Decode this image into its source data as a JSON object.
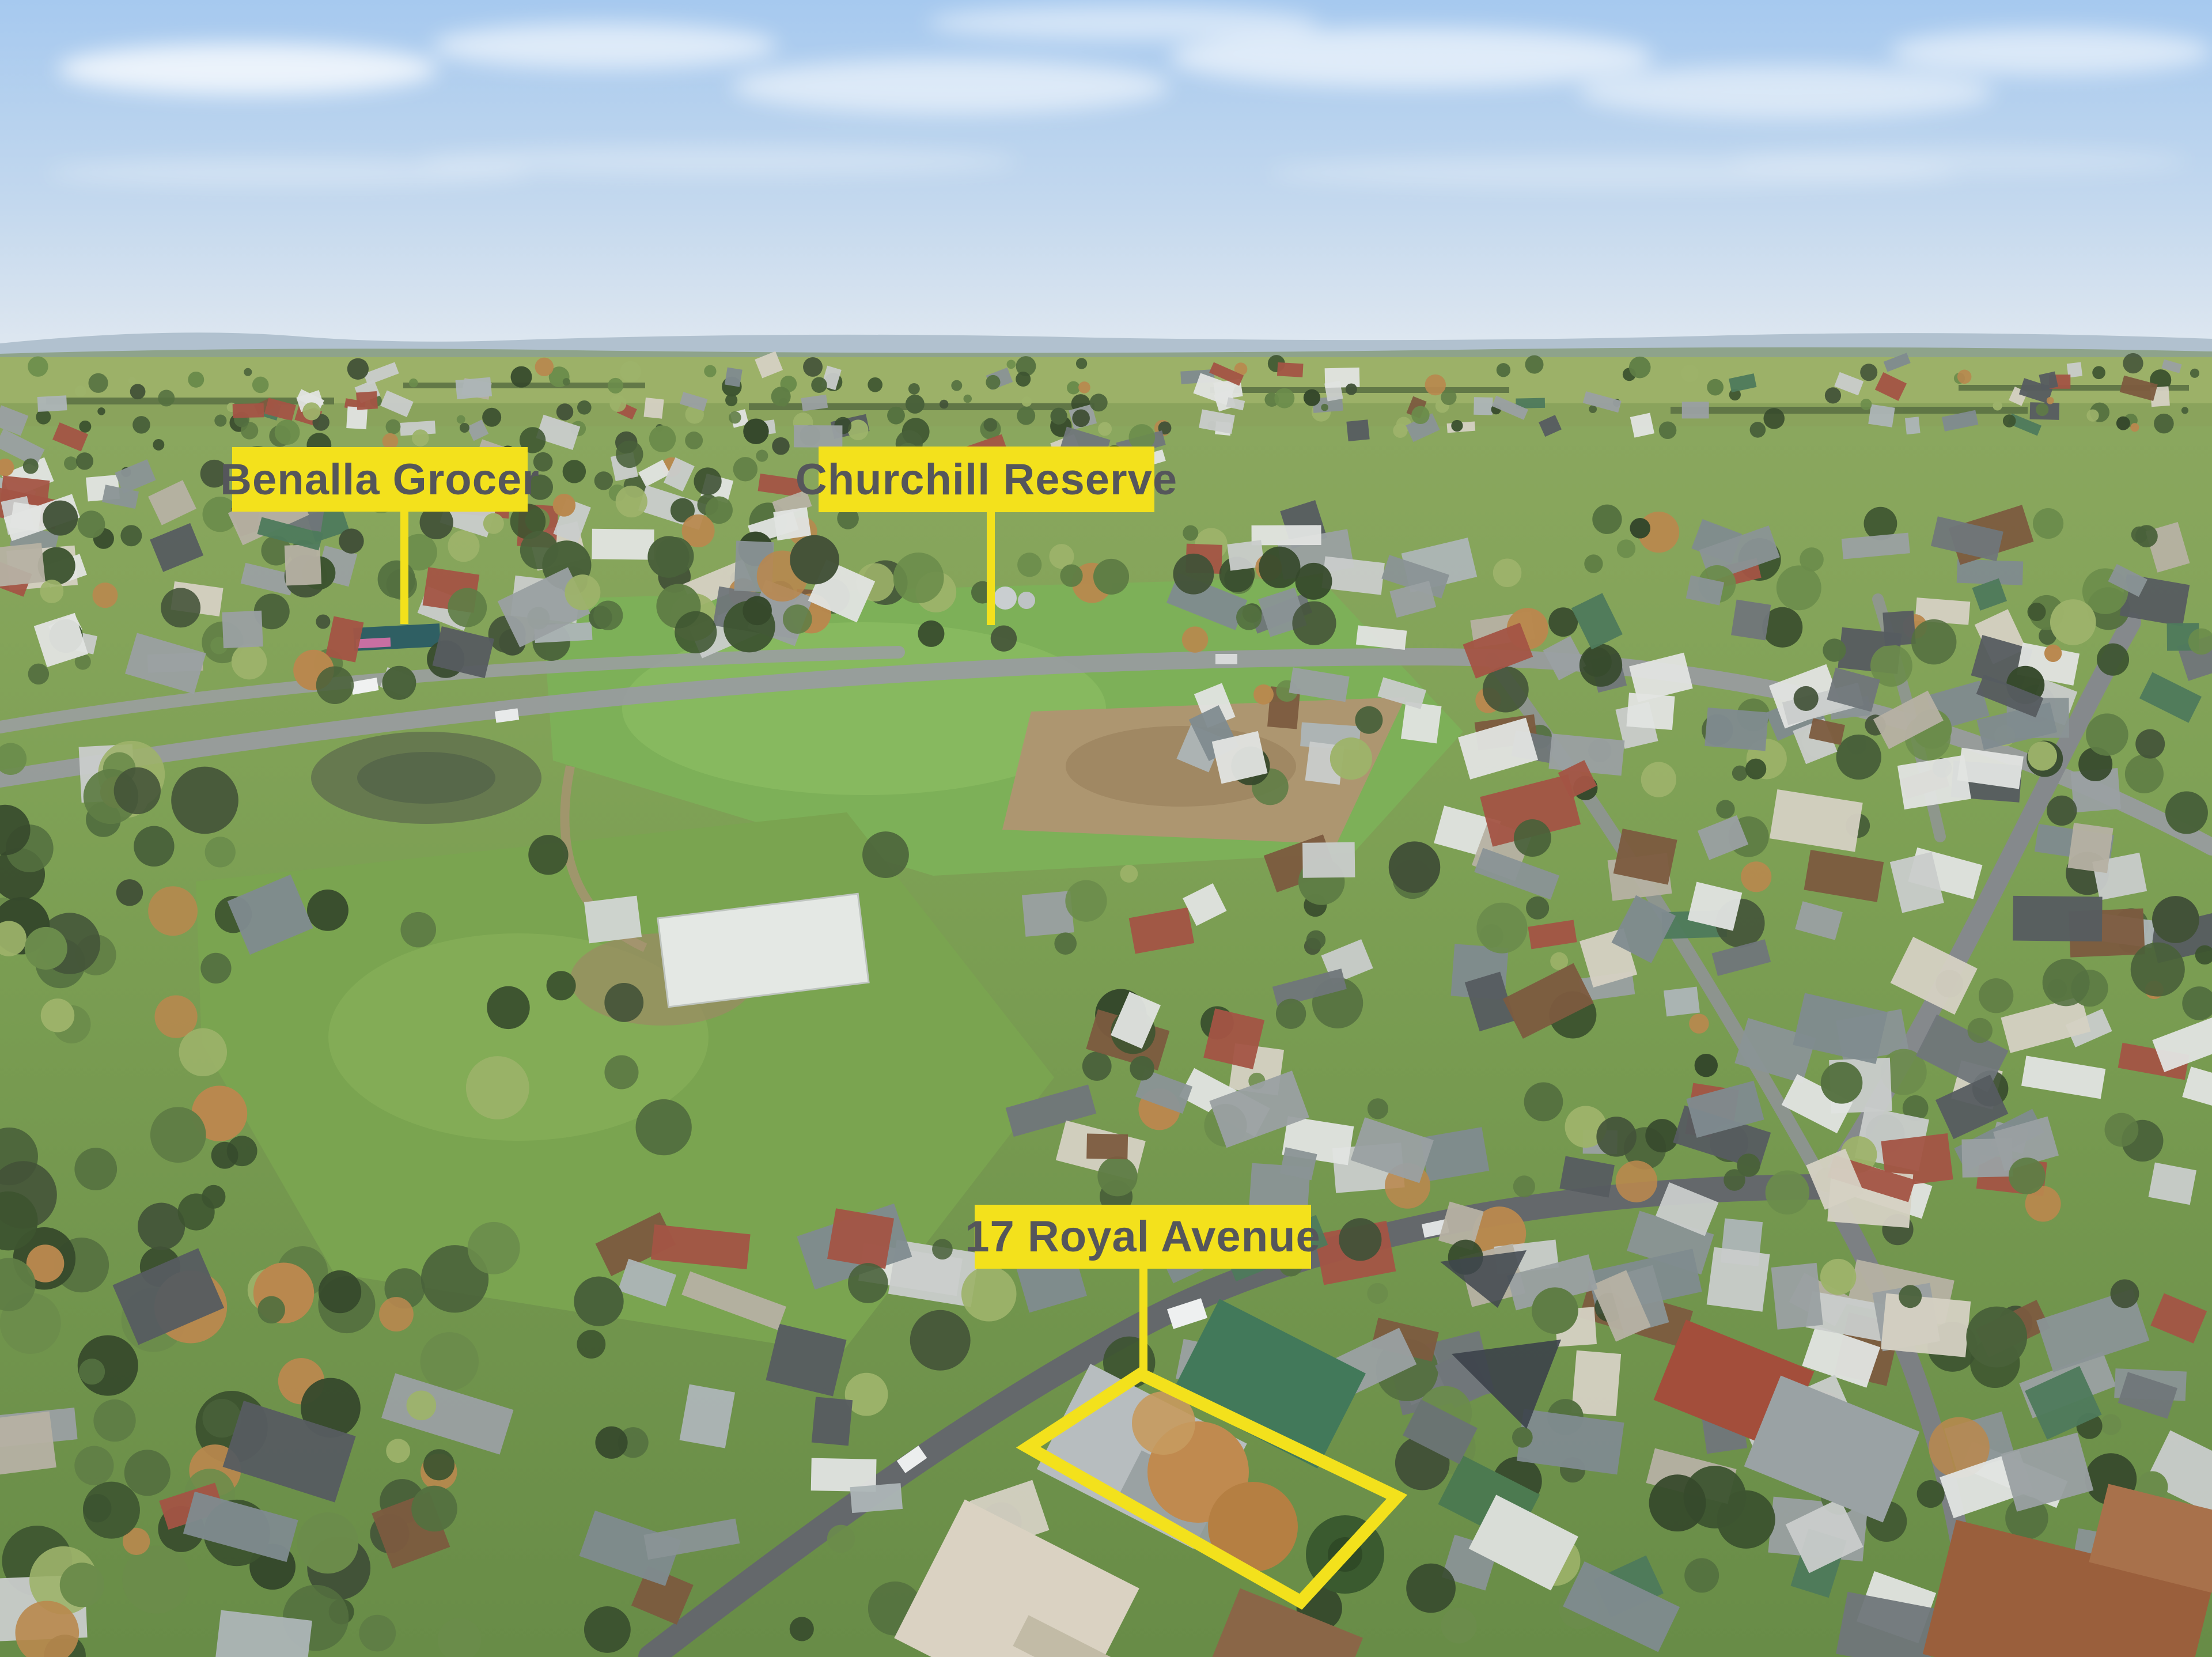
{
  "annotations": {
    "labels": [
      {
        "id": "benalla-grocer",
        "text": "Benalla Grocer"
      },
      {
        "id": "churchill-reserve",
        "text": "Churchill Reserve"
      },
      {
        "id": "royal-avenue",
        "text": "17 Royal Avenue"
      }
    ],
    "boundary_points": "1980,2385 2425,2598 2258,2780 1785,2512",
    "highlight_color": "#F3E11C",
    "label_text_color": "#55565B"
  }
}
